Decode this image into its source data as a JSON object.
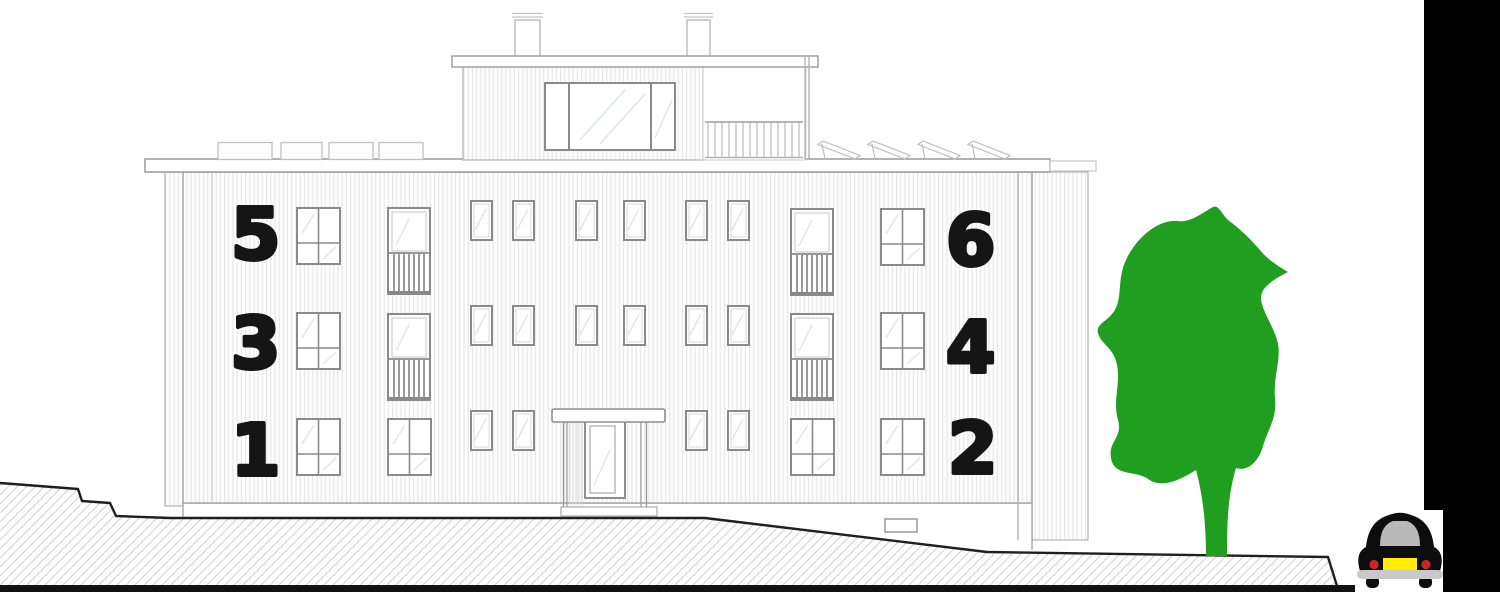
{
  "drawing": {
    "kind": "apartment-building-elevation",
    "floors": 3
  },
  "units": {
    "left": [
      {
        "label": "5"
      },
      {
        "label": "3"
      },
      {
        "label": "1"
      }
    ],
    "right": [
      {
        "label": "6"
      },
      {
        "label": "4"
      },
      {
        "label": "2"
      }
    ]
  },
  "icons": {
    "tree": "tree-icon",
    "car": "car-rear-icon"
  },
  "colors": {
    "tree_green": "#1f9e1f",
    "car_body": "#0d0d0d",
    "car_window": "#b9b9b9",
    "license_plate_yellow": "#ffee00",
    "taillight_red": "#cc2626",
    "bumper_gray": "#c9c9c9",
    "ground_line": "#1f1f1f",
    "sidebar_black": "#000000",
    "number_black": "#151515",
    "line_gray": "#9a9a9a"
  }
}
